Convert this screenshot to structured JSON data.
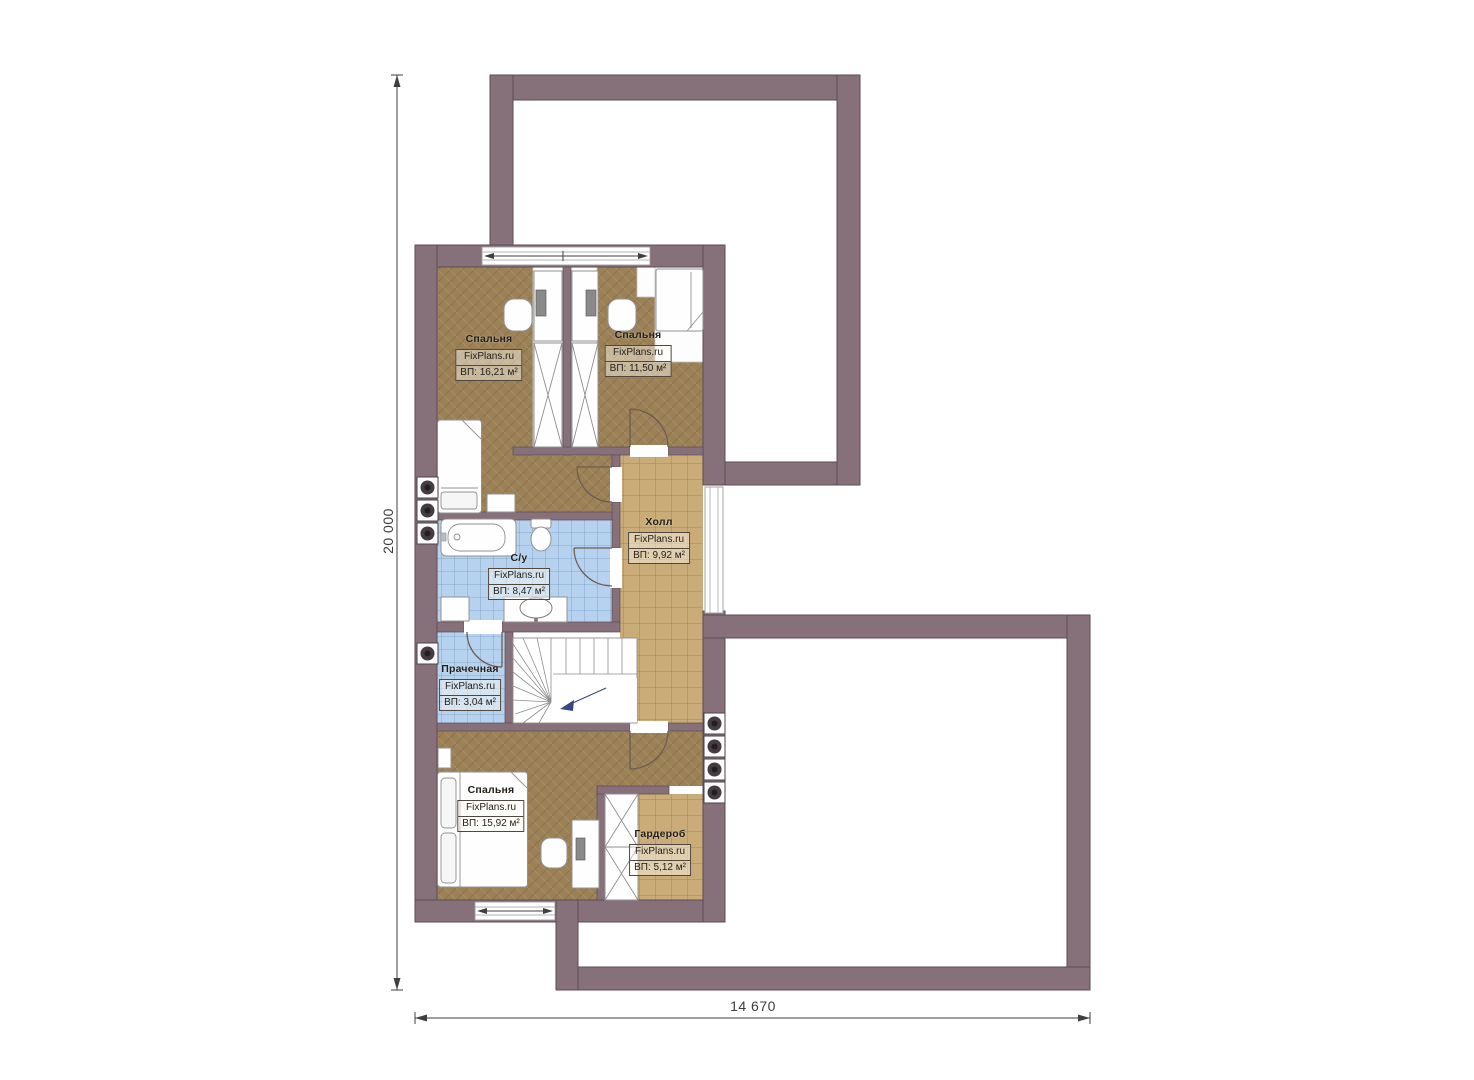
{
  "plan": {
    "brand": "FixPlans.ru",
    "dimensions": {
      "left": "20 000",
      "bottom": "14 670"
    },
    "rooms": [
      {
        "id": "bedroom-top-left",
        "name": "Спальня",
        "brand": "FixPlans.ru",
        "area": "ВП: 16,21 м²"
      },
      {
        "id": "bedroom-top-right",
        "name": "Спальня",
        "brand": "FixPlans.ru",
        "area": "ВП: 11,50 м²"
      },
      {
        "id": "hall",
        "name": "Холл",
        "brand": "FixPlans.ru",
        "area": "ВП: 9,92 м²"
      },
      {
        "id": "bathroom",
        "name": "С/у",
        "brand": "FixPlans.ru",
        "area": "ВП: 8,47 м²"
      },
      {
        "id": "laundry",
        "name": "Прачечная",
        "brand": "FixPlans.ru",
        "area": "ВП: 3,04 м²"
      },
      {
        "id": "bedroom-bottom",
        "name": "Спальня",
        "brand": "FixPlans.ru",
        "area": "ВП: 15,92 м²"
      },
      {
        "id": "wardrobe",
        "name": "Гардероб",
        "brand": "FixPlans.ru",
        "area": "ВП: 5,12 м²"
      }
    ],
    "colors": {
      "wall": "#86707a",
      "wall-stroke": "#5d4b54",
      "floor-wood": "#9c8157",
      "floor-tile": "#c9ac77",
      "floor-wet": "#b6d2ee",
      "door": "#6d5b51",
      "dim": "#3f3f3f",
      "furn-stroke": "#919191",
      "stairs-arrow": "#39477f"
    }
  }
}
